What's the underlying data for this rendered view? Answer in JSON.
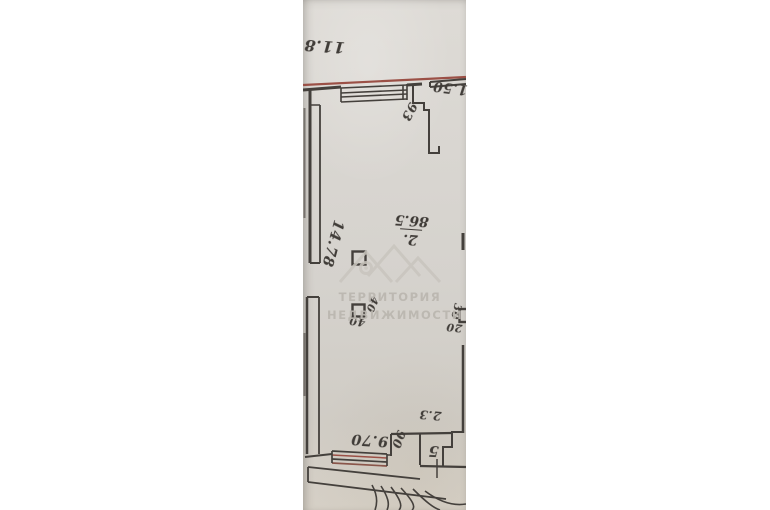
{
  "photo": {
    "type_note": "rotated photo of an archival floor plan",
    "watermark": {
      "line1": "ТЕРРИТОРИЯ",
      "line2": "НЕДВИЖИМОСТИ"
    },
    "labels": {
      "top_dimension": "11.8",
      "entry_dimension": "1.50",
      "door_width": "93",
      "left_wall_dimension": "14.78",
      "room_number": "2.",
      "room_area": "86.5",
      "column_label_side": "40",
      "column_label_bottom": "40",
      "edge_column_label_side": "30",
      "edge_column_label_bottom": "20",
      "bottom_dimension": "9.70",
      "step_dimension": "90",
      "closet_dimension": "2.3",
      "closet_number": "5"
    },
    "colors": {
      "paper": "#d7d4cf",
      "ink": "#44403c",
      "red_ink": "#9b5046",
      "watermark": "#bab6af"
    }
  }
}
